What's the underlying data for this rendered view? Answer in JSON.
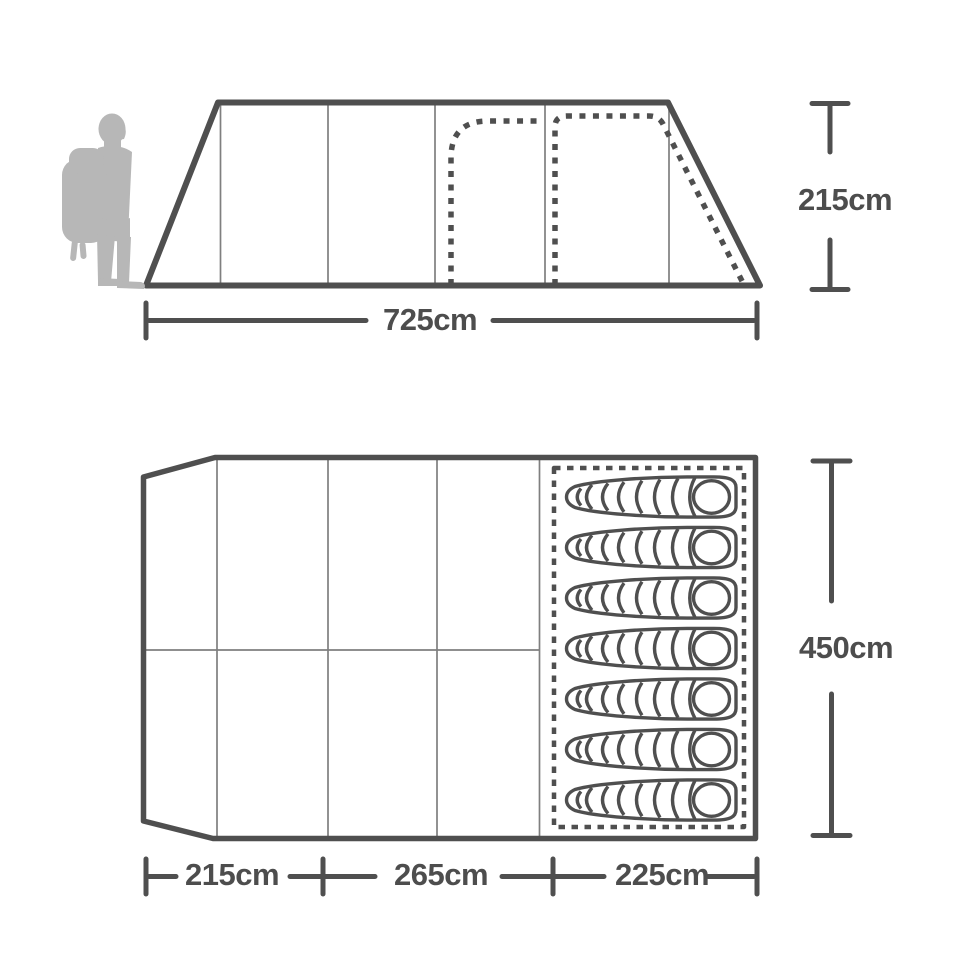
{
  "title": "Tent dimensions diagram",
  "colors": {
    "line": "#4f4f4f",
    "thin_line": "#7f7f7f",
    "silhouette": "#b7b7b7",
    "background": "#ffffff"
  },
  "side_view": {
    "description": "Tent side elevation with two dashed door outlines",
    "width_label": "725cm",
    "height_label": "215cm",
    "panel_count": 5
  },
  "floor_plan": {
    "description": "Tent floor plan with sleeping area",
    "depth_label": "450cm",
    "section_labels": [
      "215cm",
      "265cm",
      "225cm"
    ],
    "sleeping_bag_count": 7
  },
  "icons": {
    "hiker": "hiker-silhouette-icon",
    "sleeping_bag": "sleeping-bag-icon"
  }
}
